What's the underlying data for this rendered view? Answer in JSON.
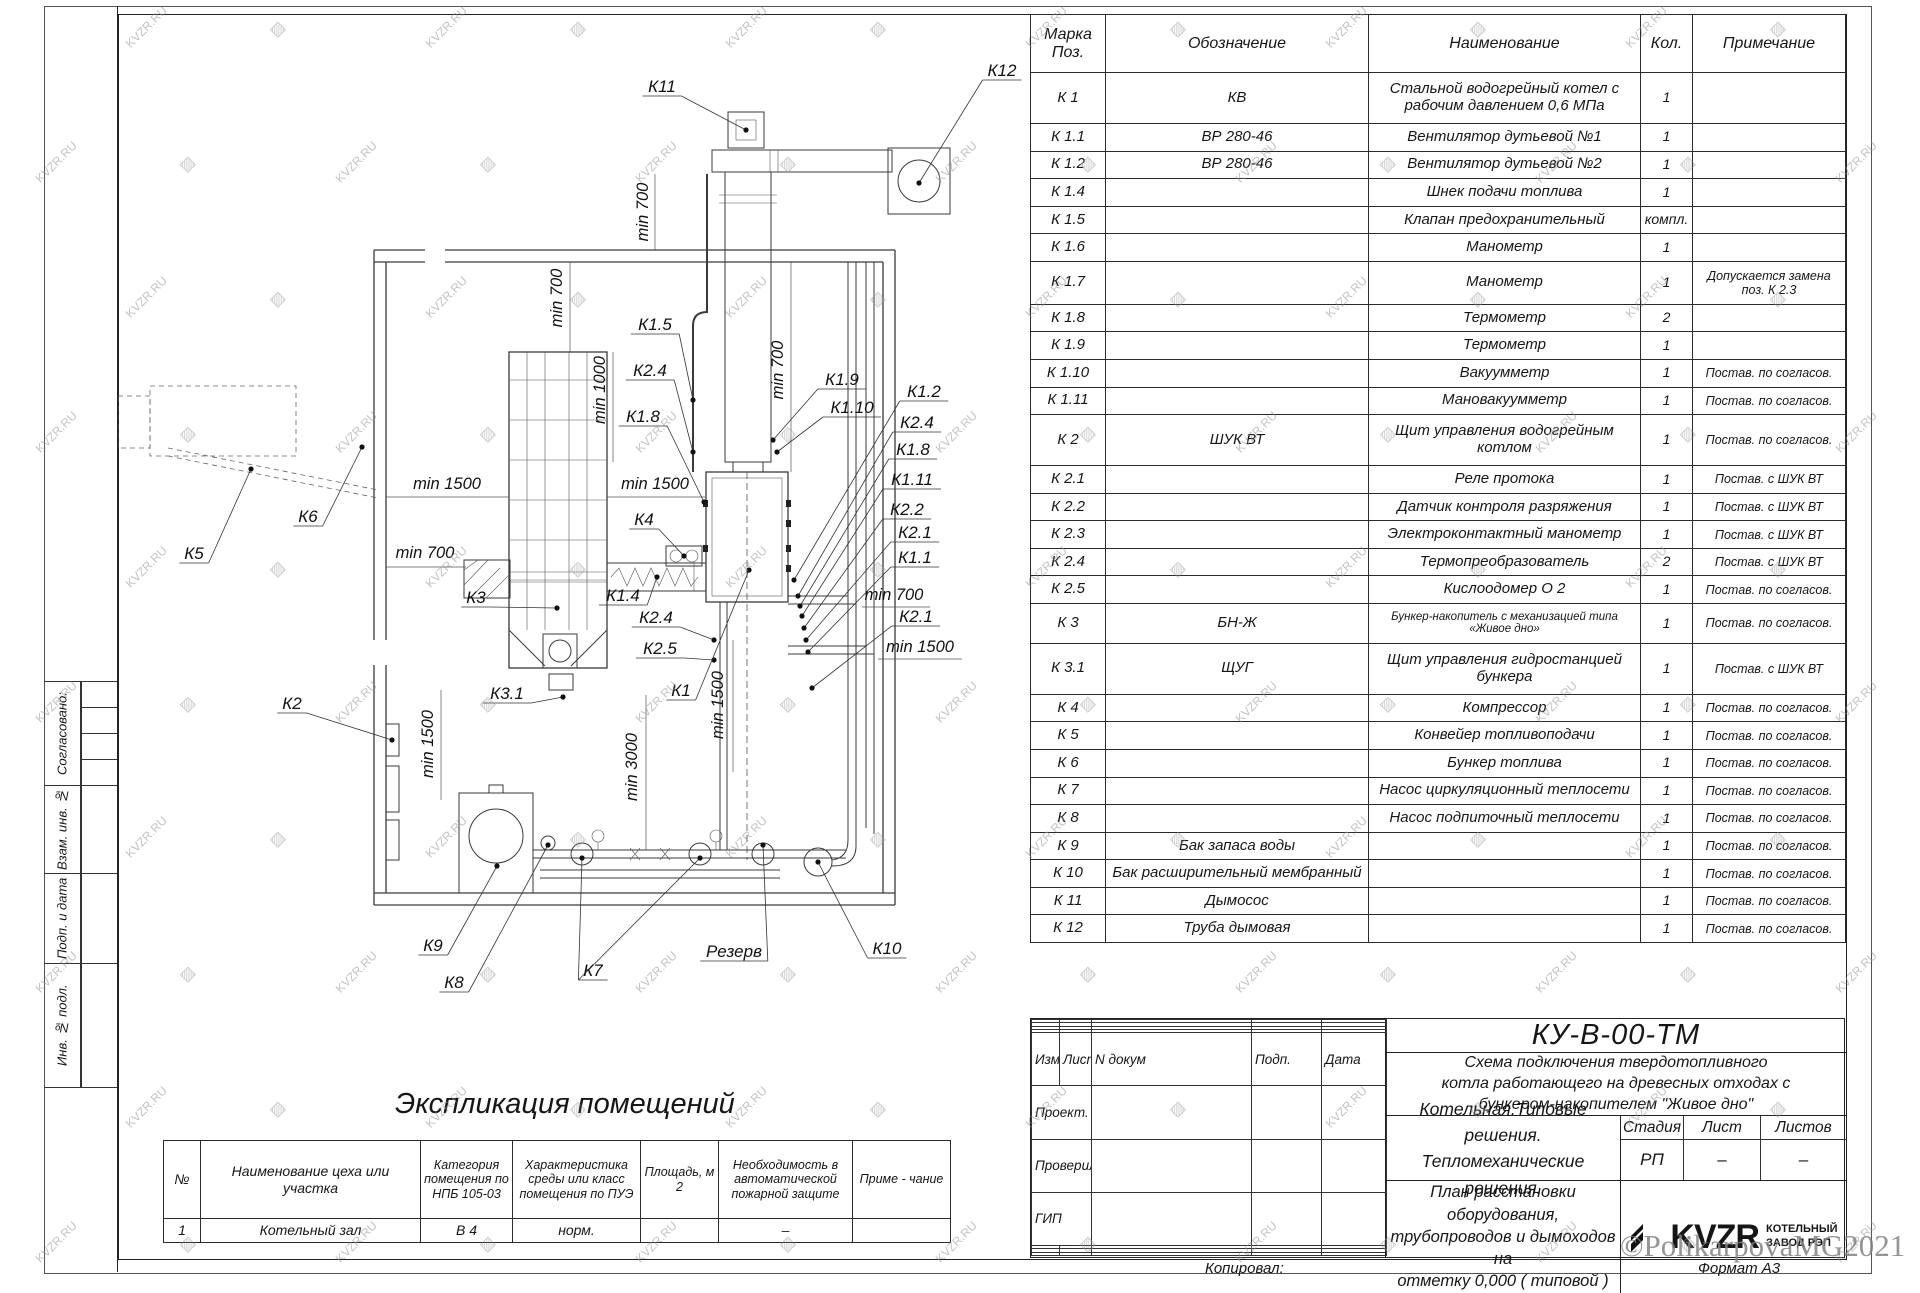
{
  "watermark": {
    "text": "KVZR.RU",
    "credit": "©PolikarpovaMG2021"
  },
  "side_labels": [
    "Согласовано:",
    "Взам. инв. №",
    "Подп. и дата",
    "Инв. № подл."
  ],
  "spec_table": {
    "headers": {
      "mark": "Марка Поз.",
      "designation": "Обозначение",
      "name": "Наименование",
      "qty": "Кол.",
      "note": "Примечание"
    },
    "rows": [
      {
        "m": "К 1",
        "d": "КВ",
        "n": "Стальной водогрейный котел с рабочим давлением 0,6 МПа",
        "q": "1",
        "p": ""
      },
      {
        "m": "К 1.1",
        "d": "ВР 280-46",
        "n": "Вентилятор дутьевой №1",
        "q": "1",
        "p": ""
      },
      {
        "m": "К 1.2",
        "d": "ВР 280-46",
        "n": "Вентилятор дутьевой №2",
        "q": "1",
        "p": ""
      },
      {
        "m": "К 1.4",
        "d": "",
        "n": "Шнек подачи топлива",
        "q": "1",
        "p": ""
      },
      {
        "m": "К 1.5",
        "d": "",
        "n": "Клапан предохранительный",
        "q": "компл.",
        "p": ""
      },
      {
        "m": "К 1.6",
        "d": "",
        "n": "Манометр",
        "q": "1",
        "p": ""
      },
      {
        "m": "К 1.7",
        "d": "",
        "n": "Манометр",
        "q": "1",
        "p": "Допускается замена поз. К 2.3"
      },
      {
        "m": "К 1.8",
        "d": "",
        "n": "Термометр",
        "q": "2",
        "p": ""
      },
      {
        "m": "К 1.9",
        "d": "",
        "n": "Термометр",
        "q": "1",
        "p": ""
      },
      {
        "m": "К 1.10",
        "d": "",
        "n": "Вакуумметр",
        "q": "1",
        "p": "Постав. по согласов."
      },
      {
        "m": "К 1.11",
        "d": "",
        "n": "Мановакуумметр",
        "q": "1",
        "p": "Постав. по согласов."
      },
      {
        "m": "К 2",
        "d": "ШУК ВТ",
        "n": "Щит управления водогрейным котлом",
        "q": "1",
        "p": "Постав. по согласов."
      },
      {
        "m": "К 2.1",
        "d": "",
        "n": "Реле протока",
        "q": "1",
        "p": "Постав. с ШУК ВТ"
      },
      {
        "m": "К 2.2",
        "d": "",
        "n": "Датчик контроля разряжения",
        "q": "1",
        "p": "Постав. с ШУК ВТ"
      },
      {
        "m": "К 2.3",
        "d": "",
        "n": "Электроконтактный манометр",
        "q": "1",
        "p": "Постав. с ШУК ВТ"
      },
      {
        "m": "К 2.4",
        "d": "",
        "n": "Термопреобразователь",
        "q": "2",
        "p": "Постав. с ШУК ВТ"
      },
      {
        "m": "К 2.5",
        "d": "",
        "n": "Кислоодомер О 2",
        "q": "1",
        "p": "Постав. по согласов."
      },
      {
        "m": "К 3",
        "d": "БН-Ж",
        "n": "Бункер-накопитель с механизацией типа «Живое дно»",
        "q": "1",
        "p": "Постав. по согласов.",
        "small": true
      },
      {
        "m": "К 3.1",
        "d": "ЩУГ",
        "n": "Щит управления гидростанцией бункера",
        "q": "1",
        "p": "Постав. с ШУК ВТ"
      },
      {
        "m": "К 4",
        "d": "",
        "n": "Компрессор",
        "q": "1",
        "p": "Постав. по согласов."
      },
      {
        "m": "К 5",
        "d": "",
        "n": "Конвейер топливоподачи",
        "q": "1",
        "p": "Постав. по согласов."
      },
      {
        "m": "К 6",
        "d": "",
        "n": "Бункер топлива",
        "q": "1",
        "p": "Постав. по согласов."
      },
      {
        "m": "К 7",
        "d": "",
        "n": "Насос циркуляционный теплосети",
        "q": "1",
        "p": "Постав. по согласов."
      },
      {
        "m": "К 8",
        "d": "",
        "n": "Насос подпиточный теплосети",
        "q": "1",
        "p": "Постав. по согласов."
      },
      {
        "m": "К 9",
        "d": "Бак запаса воды",
        "n": "",
        "q": "1",
        "p": "Постав. по согласов."
      },
      {
        "m": "К 10",
        "d": "Бак расширительный мембранный",
        "n": "",
        "q": "1",
        "p": "Постав. по согласов."
      },
      {
        "m": "К 11",
        "d": "Дымосос",
        "n": "",
        "q": "1",
        "p": "Постав. по согласов."
      },
      {
        "m": "К 12",
        "d": "Труба дымовая",
        "n": "",
        "q": "1",
        "p": "Постав. по согласов."
      }
    ]
  },
  "room_table": {
    "title": "Экспликация помещений",
    "headers": [
      "№",
      "Наименование цеха или участка",
      "Категория помещения по НПБ 105-03",
      "Характеристика среды или класс помещения по ПУЭ",
      "Площадь, м 2",
      "Необходимость в автоматической пожарной защите",
      "Приме - чание"
    ],
    "row": [
      "1",
      "Котельный зал",
      "В 4",
      "норм.",
      "",
      "–",
      ""
    ]
  },
  "title_block": {
    "code": "КУ-В-00-ТМ",
    "description": "Схема подключения твердотопливного\nкотла работающего на древесных отходах с\nбункером-накопителем \"Живое дно\"",
    "rev_headers": [
      "Изм",
      "Лист",
      "N докум",
      "Подп.",
      "Дата"
    ],
    "rev_rows": [
      "Проект.",
      "Проверил",
      "ГИП"
    ],
    "project": "Котельная.Типовые решения.\nТепломеханические решения.",
    "plan": "План расстановки оборудования,\nтрубопроводов и дымоходов на\nотметку 0,000 ( типовой )",
    "stage_headers": [
      "Стадия",
      "Лист",
      "Листов"
    ],
    "stage_values": [
      "РП",
      "–",
      "–"
    ],
    "logo_word": "KVZR",
    "company": "КОТЕЛЬНЫЙ\nЗАВОД РЭП",
    "copied": "Копировал:",
    "format": "Формат А3"
  },
  "drawing": {
    "callouts": [
      {
        "t": "К11",
        "x": 662,
        "y": 92,
        "tx": 746,
        "ty": 130
      },
      {
        "t": "К12",
        "x": 1002,
        "y": 76,
        "tx": 919,
        "ty": 183
      },
      {
        "t": "К1.5",
        "x": 655,
        "y": 330,
        "tx": 693,
        "ty": 400
      },
      {
        "t": "К2.4",
        "x": 650,
        "y": 376,
        "tx": 693,
        "ty": 452
      },
      {
        "t": "К1.8",
        "x": 643,
        "y": 422,
        "tx": 704,
        "ty": 502
      },
      {
        "t": "К1.9",
        "x": 842,
        "y": 385,
        "tx": 773,
        "ty": 440
      },
      {
        "t": "К1.10",
        "x": 852,
        "y": 413,
        "tx": 777,
        "ty": 452
      },
      {
        "t": "К1.2",
        "x": 924,
        "y": 397,
        "tx": 794,
        "ty": 580
      },
      {
        "t": "К2.4",
        "x": 917,
        "y": 428,
        "tx": 798,
        "ty": 596
      },
      {
        "t": "К1.8",
        "x": 913,
        "y": 455,
        "tx": 800,
        "ty": 606
      },
      {
        "t": "К1.11",
        "x": 912,
        "y": 485,
        "tx": 802,
        "ty": 616
      },
      {
        "t": "К2.2",
        "x": 907,
        "y": 515,
        "tx": 804,
        "ty": 628
      },
      {
        "t": "К2.1",
        "x": 915,
        "y": 538,
        "tx": 806,
        "ty": 640
      },
      {
        "t": "К1.1",
        "x": 915,
        "y": 563,
        "tx": 808,
        "ty": 652
      },
      {
        "t": "К2.1",
        "x": 916,
        "y": 622,
        "tx": 812,
        "ty": 688
      },
      {
        "t": "К4",
        "x": 644,
        "y": 525,
        "tx": 684,
        "ty": 556
      },
      {
        "t": "К1.4",
        "x": 623,
        "y": 601,
        "tx": 657,
        "ty": 577
      },
      {
        "t": "К2.4",
        "x": 656,
        "y": 623,
        "tx": 714,
        "ty": 640
      },
      {
        "t": "К2.5",
        "x": 660,
        "y": 654,
        "tx": 714,
        "ty": 660
      },
      {
        "t": "К1",
        "x": 681,
        "y": 696,
        "tx": 749,
        "ty": 570
      },
      {
        "t": "К3",
        "x": 476,
        "y": 603,
        "tx": 557,
        "ty": 608
      },
      {
        "t": "К3.1",
        "x": 507,
        "y": 699,
        "tx": 563,
        "ty": 697
      },
      {
        "t": "К2",
        "x": 292,
        "y": 709,
        "tx": 392,
        "ty": 740
      },
      {
        "t": "К5",
        "x": 194,
        "y": 559,
        "tx": 251,
        "ty": 469
      },
      {
        "t": "К6",
        "x": 308,
        "y": 522,
        "tx": 362,
        "ty": 447
      },
      {
        "t": "К9",
        "x": 433,
        "y": 951,
        "tx": 497,
        "ty": 866
      },
      {
        "t": "К8",
        "x": 454,
        "y": 988,
        "tx": 548,
        "ty": 845
      },
      {
        "t": "К7",
        "x": 593,
        "y": 976,
        "tx": 582,
        "ty": 858,
        "tx2": 700,
        "ty2": 858
      },
      {
        "t": "К10",
        "x": 887,
        "y": 954,
        "tx": 818,
        "ty": 862
      },
      {
        "t": "Резерв",
        "x": 734,
        "y": 957,
        "tx": 763,
        "ty": 845
      }
    ],
    "dims": [
      {
        "t": "min 700",
        "x": 648,
        "y": 212,
        "r": -90
      },
      {
        "t": "min 700",
        "x": 562,
        "y": 298,
        "r": -90
      },
      {
        "t": "min 1000",
        "x": 605,
        "y": 390,
        "r": -90
      },
      {
        "t": "min 700",
        "x": 783,
        "y": 370,
        "r": -90
      },
      {
        "t": "min 1500",
        "x": 447,
        "y": 489,
        "r": 0
      },
      {
        "t": "min 1500",
        "x": 655,
        "y": 489,
        "r": 0
      },
      {
        "t": "min 700",
        "x": 425,
        "y": 558,
        "r": 0
      },
      {
        "t": "min 1500",
        "x": 433,
        "y": 744,
        "r": -90
      },
      {
        "t": "min 3000",
        "x": 637,
        "y": 767,
        "r": -90
      },
      {
        "t": "min 1500",
        "x": 723,
        "y": 705,
        "r": -90
      },
      {
        "t": "min 700",
        "x": 894,
        "y": 600,
        "r": 0
      },
      {
        "t": "min 1500",
        "x": 920,
        "y": 652,
        "r": 0
      }
    ]
  }
}
